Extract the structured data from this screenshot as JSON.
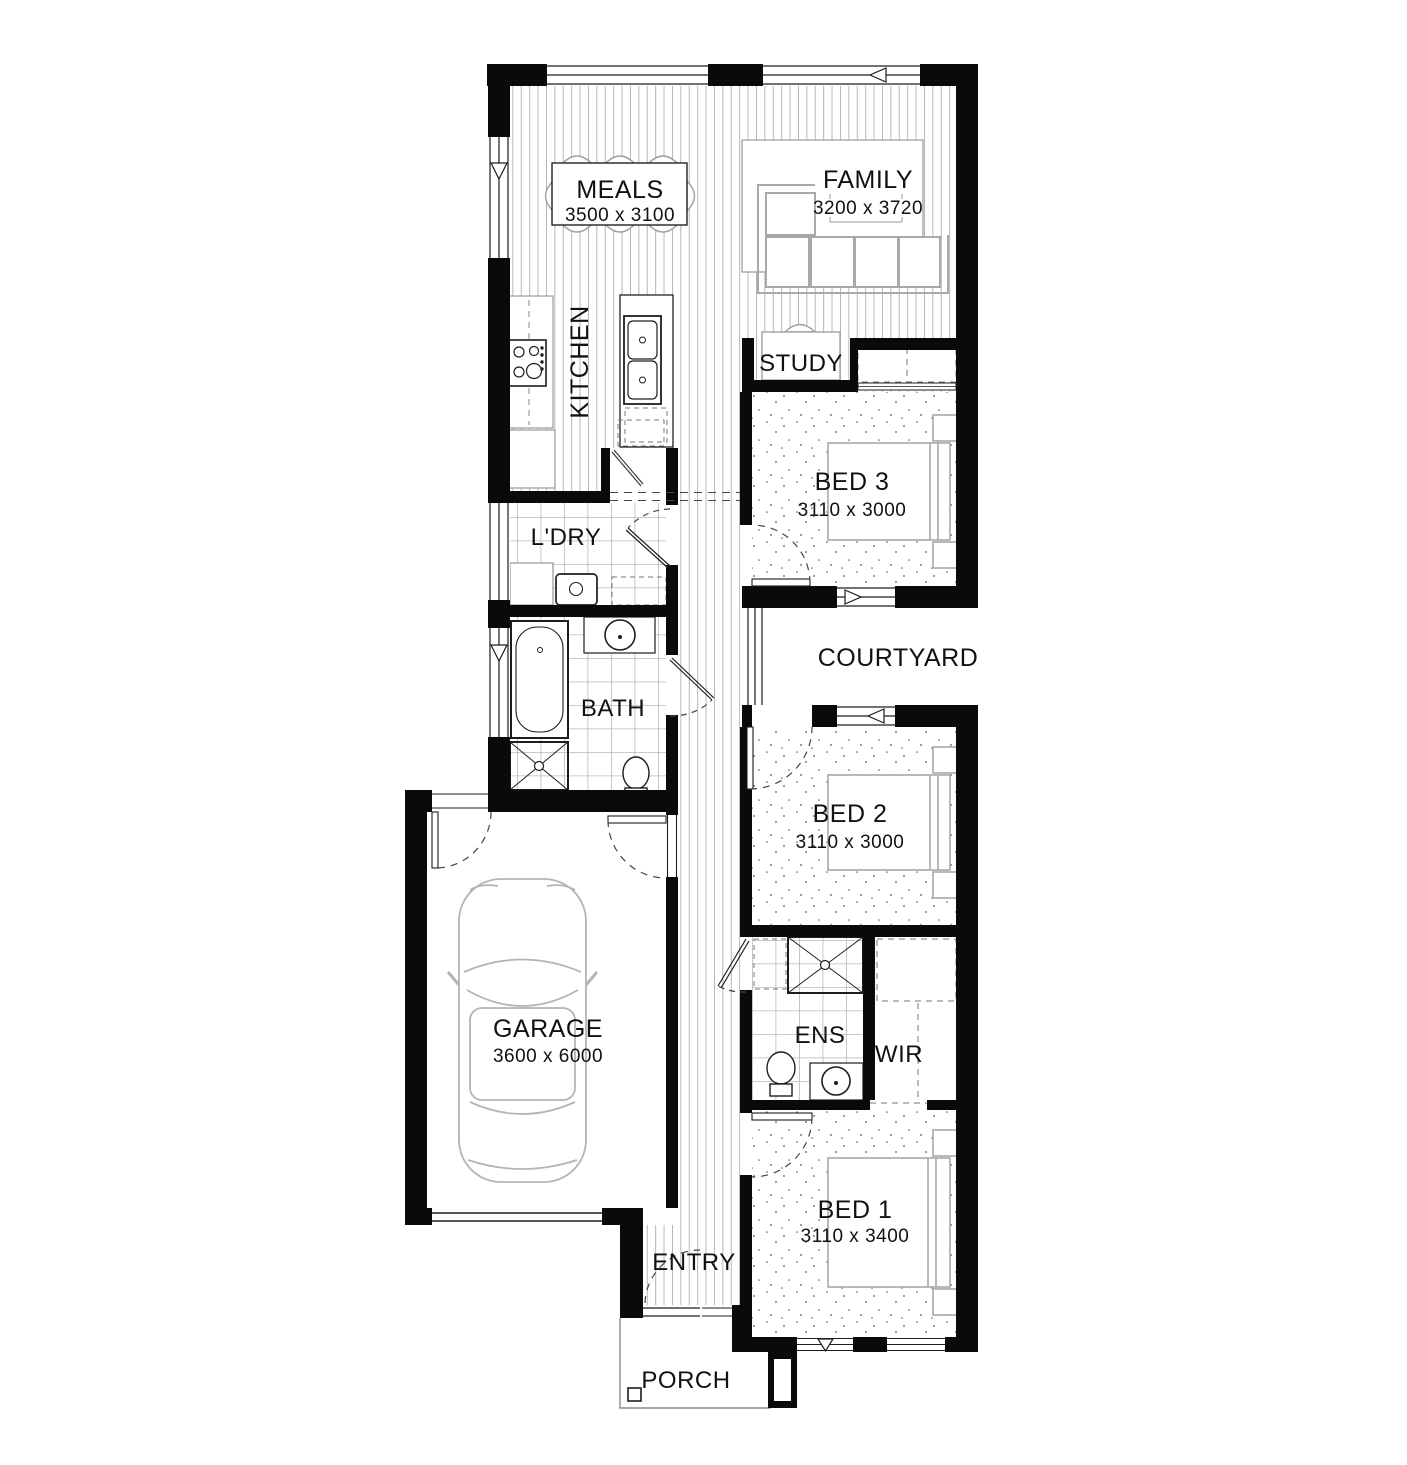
{
  "plan_title": "Single storey home floor plan",
  "rooms": {
    "meals": {
      "label": "MEALS",
      "dims": "3500 x 3100"
    },
    "family": {
      "label": "FAMILY",
      "dims": "3200 x 3720"
    },
    "kitchen": {
      "label": "KITCHEN"
    },
    "study": {
      "label": "STUDY"
    },
    "bed3": {
      "label": "BED 3",
      "dims": "3110 x 3000"
    },
    "ldry": {
      "label": "L'DRY"
    },
    "courtyard": {
      "label": "COURTYARD"
    },
    "bath": {
      "label": "BATH"
    },
    "bed2": {
      "label": "BED 2",
      "dims": "3110 x 3000"
    },
    "garage": {
      "label": "GARAGE",
      "dims": "3600 x 6000"
    },
    "ens": {
      "label": "ENS"
    },
    "wir": {
      "label": "WIR"
    },
    "bed1": {
      "label": "BED 1",
      "dims": "3110 x 3400"
    },
    "entry": {
      "label": "ENTRY"
    },
    "porch": {
      "label": "PORCH"
    }
  },
  "colors": {
    "wall": "#0a0a0a",
    "fixture": "#1d1d1d",
    "furniture": "#a8a8a8",
    "floor_line": "#ababab",
    "text": "#111111"
  }
}
